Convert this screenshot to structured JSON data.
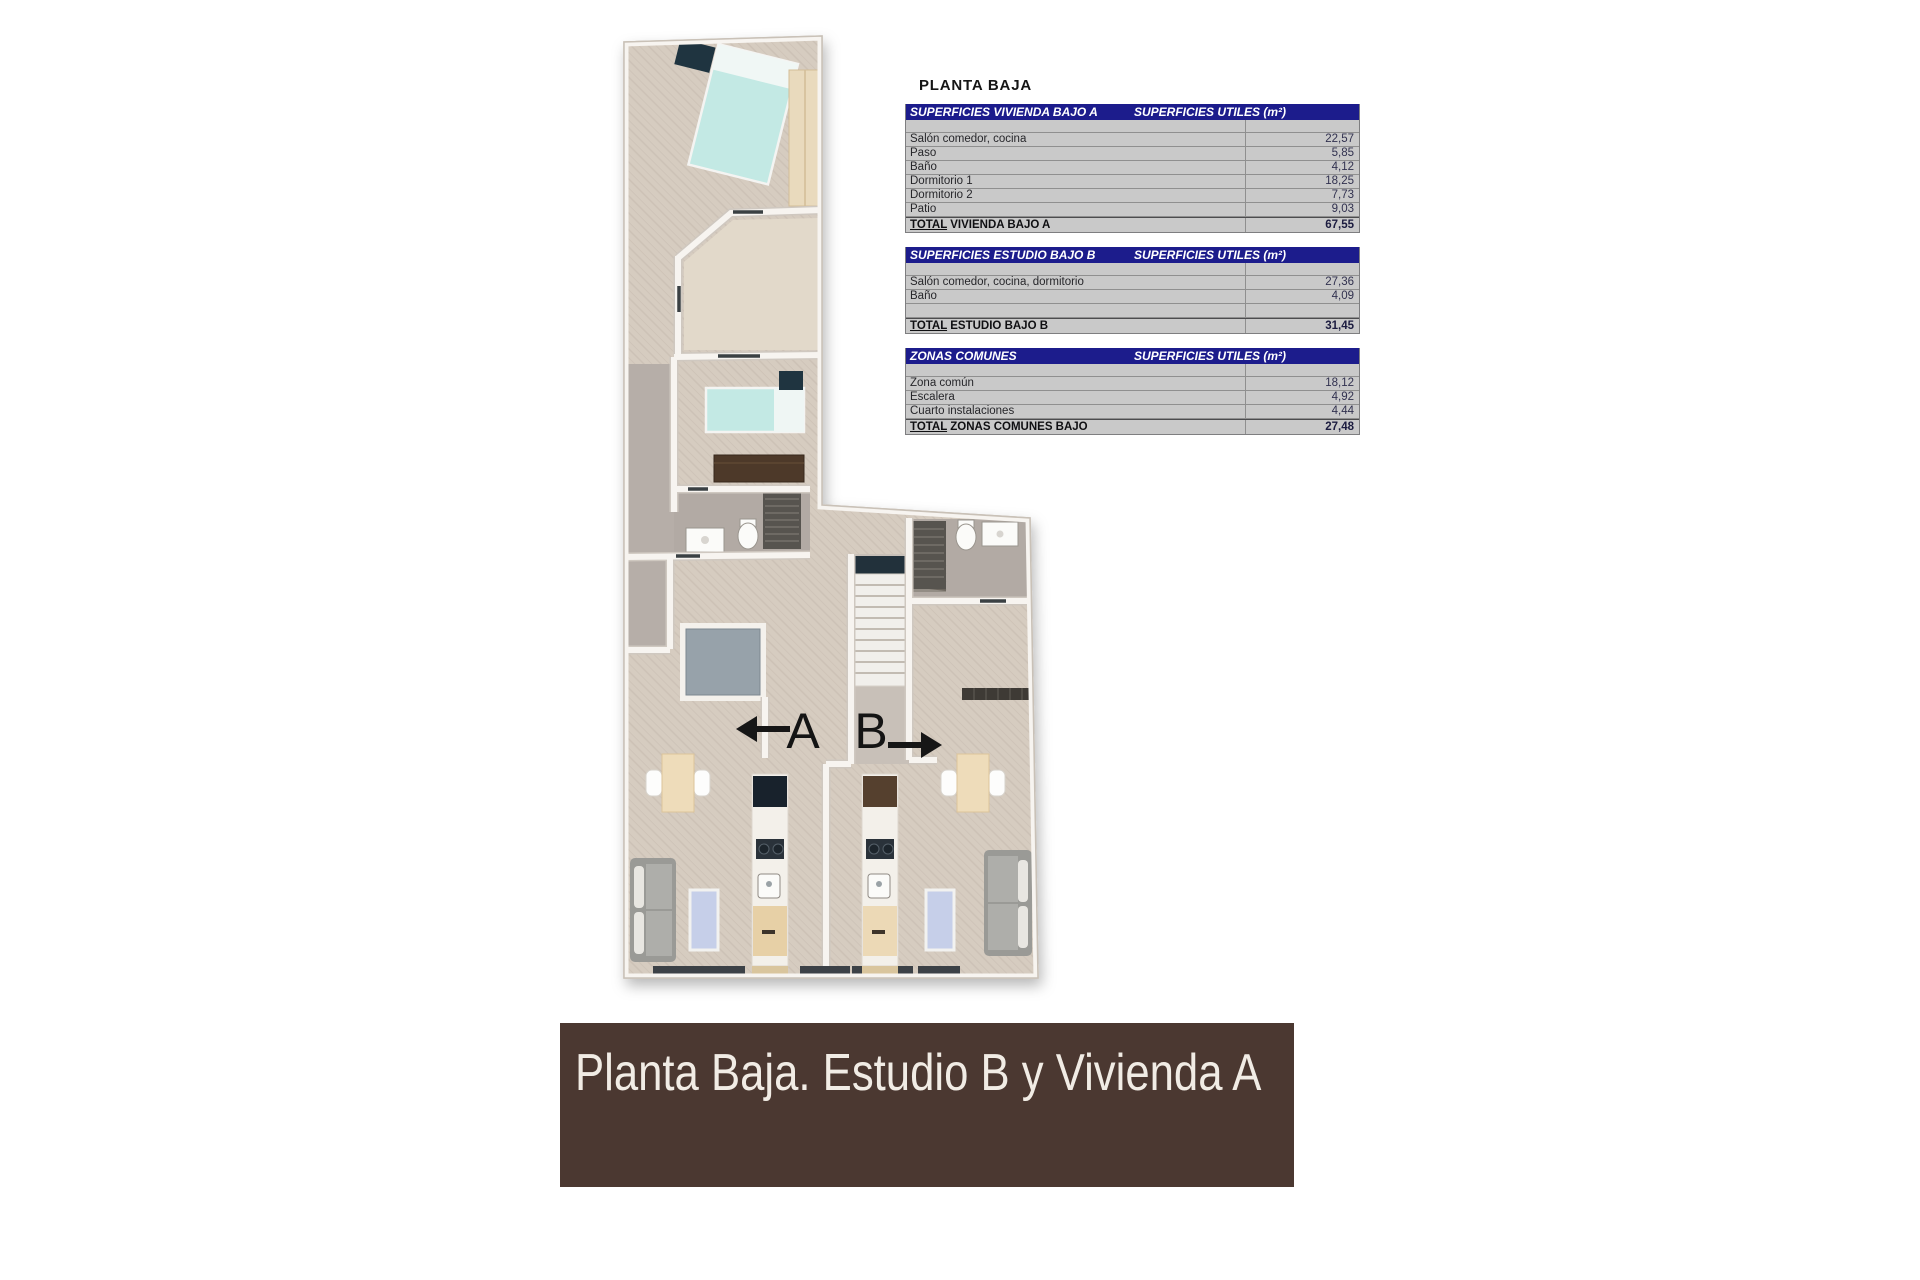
{
  "plan_title": "PLANTA BAJA",
  "tables": [
    {
      "title": "SUPERFICIES VIVIENDA BAJO A",
      "units_header": "SUPERFICIES UTILES  (m²)",
      "rows": [
        {
          "label": "Salón comedor, cocina",
          "value": "22,57"
        },
        {
          "label": "Paso",
          "value": "5,85"
        },
        {
          "label": "Baño",
          "value": "4,12"
        },
        {
          "label": "Dormitorio 1",
          "value": "18,25"
        },
        {
          "label": "Dormitorio 2",
          "value": "7,73"
        },
        {
          "label": "Patio",
          "value": "9,03"
        }
      ],
      "total": {
        "label": "TOTAL VIVIENDA BAJO A",
        "value": "67,55"
      }
    },
    {
      "title": "SUPERFICIES ESTUDIO BAJO B",
      "units_header": "SUPERFICIES UTILES  (m²)",
      "rows": [
        {
          "label": "Salón comedor, cocina, dormitorio",
          "value": "27,36"
        },
        {
          "label": "Baño",
          "value": "4,09"
        },
        {
          "label": "",
          "value": ""
        }
      ],
      "total": {
        "label": "TOTAL ESTUDIO BAJO B",
        "value": "31,45"
      }
    },
    {
      "title": "ZONAS COMUNES",
      "units_header": "SUPERFICIES UTILES  (m²)",
      "rows": [
        {
          "label": "Zona común",
          "value": "18,12"
        },
        {
          "label": "Escalera",
          "value": "4,92"
        },
        {
          "label": "Cuarto instalaciones",
          "value": "4,44"
        }
      ],
      "total": {
        "label": "TOTAL ZONAS COMUNES BAJO",
        "value": "27,48"
      }
    }
  ],
  "plan_labels": {
    "unit_a": "A",
    "unit_b": "B"
  },
  "banner": {
    "text": "Planta Baja. Estudio B y Vivienda A"
  },
  "colors": {
    "header_bg": "#1c1c8c",
    "header_fg": "#ffffff",
    "row_bg": "#c9c9c9",
    "banner_bg": "#4b3831",
    "banner_fg": "#f1ece5"
  }
}
